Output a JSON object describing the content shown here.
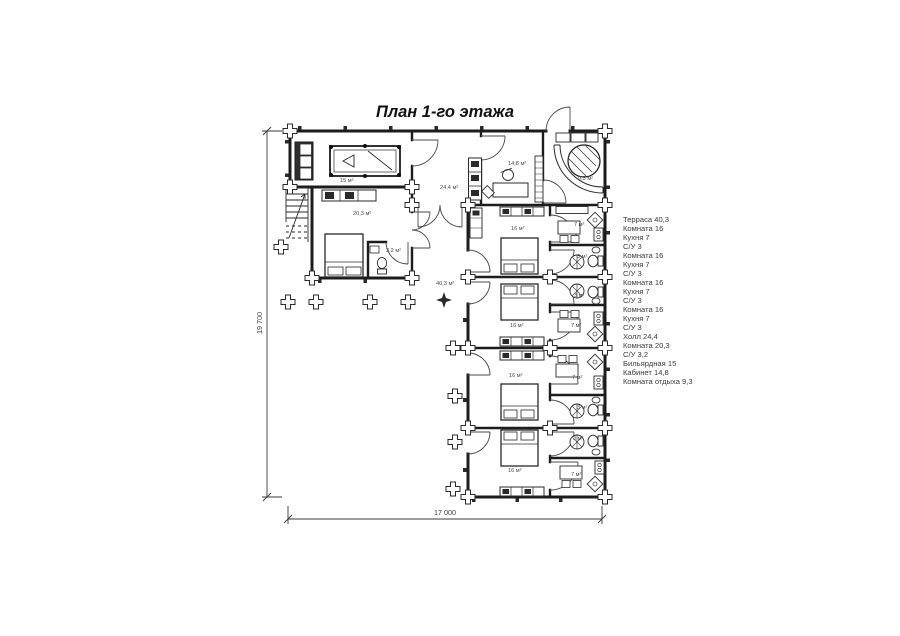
{
  "title": "План 1-го этажа",
  "dimensions": {
    "height_label": "19 700",
    "width_label": "17 000"
  },
  "rooms": {
    "billiard": "15 м²",
    "master_bedroom": "20,3 м²",
    "master_bath": "3,2 м²",
    "hall": "24,4 м²",
    "office": "14,8 м²",
    "lounge": "9,3 м²",
    "terrace": "40,3 м²",
    "units": [
      {
        "room": "16 м²",
        "kitchen": "7 м²",
        "bath": "3 м²"
      },
      {
        "room": "16 м²",
        "kitchen": "7 м²",
        "bath": "3 м²"
      },
      {
        "room": "16 м²",
        "kitchen": "7 м²",
        "bath": "3 м²"
      },
      {
        "room": "16 м²",
        "kitchen": "7 м²",
        "bath": "3 м²"
      }
    ]
  },
  "legend": {
    "items": [
      "Терраса 40,3",
      "Комната 16",
      "Кухня 7",
      "С/У 3",
      "Комната 16",
      "Кухня 7",
      "С/У 3",
      "Комната 16",
      "Кухня 7",
      "С/У 3",
      "Комната 16",
      "Кухня 7",
      "С/У 3",
      "Холл 24,4",
      "Комната 20,3",
      "С/У 3,2",
      "Бильярдная 15",
      "Кабинет 14,8",
      "Комната отдыха 9,3"
    ]
  }
}
